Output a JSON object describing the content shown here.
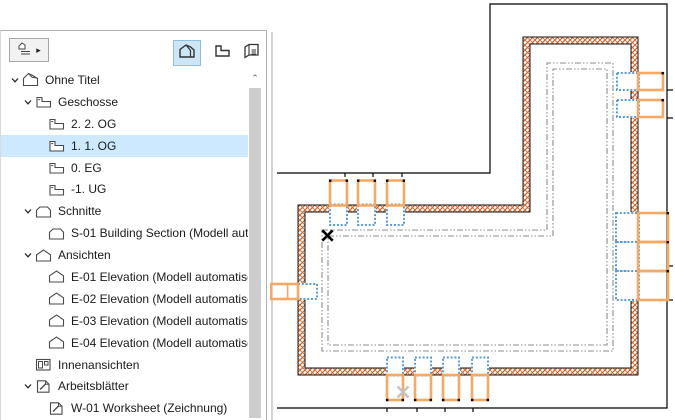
{
  "navigator": {
    "toolbar": {
      "chooser_arrow": "▸",
      "views": [
        {
          "name": "project-map",
          "selected": true
        },
        {
          "name": "view-map",
          "selected": false
        },
        {
          "name": "layout-book",
          "selected": false
        }
      ]
    },
    "scrollbar": {
      "up_arrow": "⌃"
    },
    "tree": [
      {
        "label": "Ohne Titel",
        "level": 0,
        "icon": "project",
        "expanded": true,
        "selected": false
      },
      {
        "label": "Geschosse",
        "level": 1,
        "icon": "story",
        "expanded": true,
        "selected": false
      },
      {
        "label": "2. 2. OG",
        "level": 2,
        "icon": "story",
        "selected": false
      },
      {
        "label": "1. 1. OG",
        "level": 2,
        "icon": "story",
        "selected": true
      },
      {
        "label": "0. EG",
        "level": 2,
        "icon": "story",
        "selected": false
      },
      {
        "label": "-1. UG",
        "level": 2,
        "icon": "story",
        "selected": false
      },
      {
        "label": "Schnitte",
        "level": 1,
        "icon": "section",
        "expanded": true,
        "selected": false
      },
      {
        "label": "S-01 Building Section (Modell auto",
        "level": 2,
        "icon": "section",
        "selected": false
      },
      {
        "label": "Ansichten",
        "level": 1,
        "icon": "elevation",
        "expanded": true,
        "selected": false
      },
      {
        "label": "E-01 Elevation (Modell automatisch",
        "level": 2,
        "icon": "elevation",
        "selected": false
      },
      {
        "label": "E-02 Elevation (Modell automatisch",
        "level": 2,
        "icon": "elevation",
        "selected": false
      },
      {
        "label": "E-03 Elevation (Modell automatisch",
        "level": 2,
        "icon": "elevation",
        "selected": false
      },
      {
        "label": "E-04 Elevation (Modell automatisch",
        "level": 2,
        "icon": "elevation",
        "selected": false
      },
      {
        "label": "Innenansichten",
        "level": 1,
        "icon": "interior",
        "selected": false
      },
      {
        "label": "Arbeitsblätter",
        "level": 1,
        "icon": "worksheet",
        "expanded": true,
        "selected": false
      },
      {
        "label": "W-01 Worksheet (Zeichnung)",
        "level": 2,
        "icon": "worksheet",
        "selected": false
      }
    ],
    "selection_color": "#cde9ff"
  },
  "plan": {
    "colors": {
      "wall_hatch": "#d4602a",
      "wall_edge": "#111111",
      "window_frame": "#f5a965",
      "window_ghost": "#5b9bd5",
      "reference_outline": "#000000",
      "ghost_dash": "#8c8c8c",
      "origin_marker": "#000000",
      "faint_marker": "#c3c3c3"
    },
    "windows": {
      "top": {
        "xs": [
          60,
          88,
          117
        ],
        "w": 17
      },
      "bottom": {
        "xs": [
          117,
          145,
          173,
          202
        ],
        "w": 16
      },
      "left": {
        "ys": [
          284
        ],
        "h": 15
      },
      "right_upper": {
        "ys": [
          73,
          100
        ],
        "h": 17
      },
      "right_band": {
        "ys": [
          213,
          242,
          271
        ],
        "h": 29
      }
    },
    "markers": {
      "origin": {
        "x": 57.5,
        "y": 235.5
      },
      "faint": {
        "x": 133,
        "y": 392
      }
    }
  }
}
